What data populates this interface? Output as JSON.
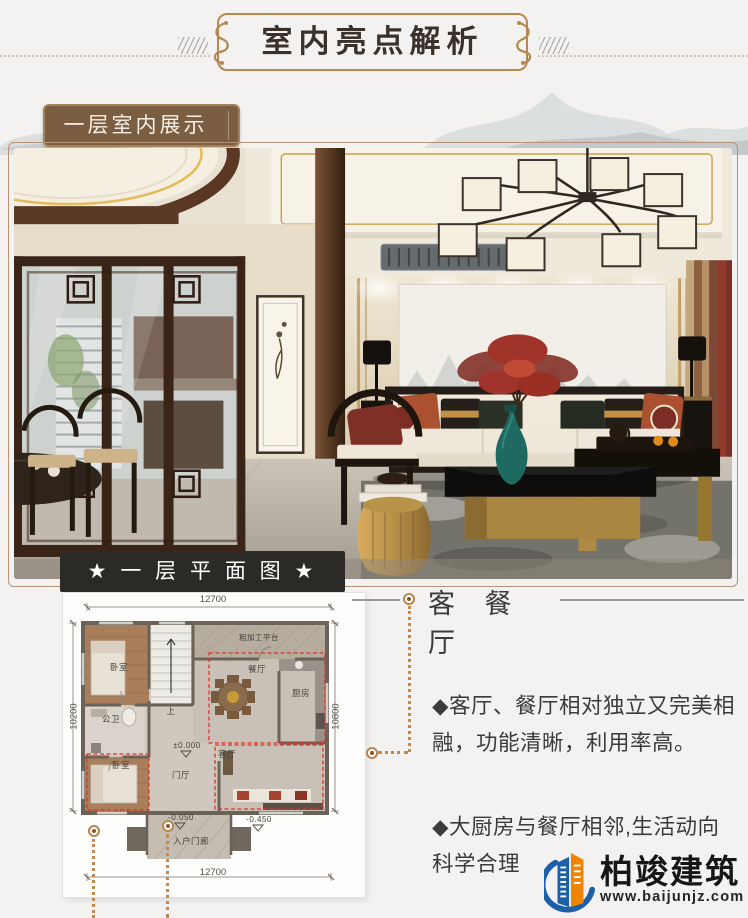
{
  "page": {
    "background": "#f3f2f0"
  },
  "header": {
    "title": "室内亮点解析",
    "frame_color": "#b4884f",
    "title_color": "#3a322a"
  },
  "section_label": {
    "text": "一层室内展示"
  },
  "plan_banner": {
    "text": "★ 一 层 平 面 图 ★"
  },
  "floor_plan": {
    "dims": {
      "top": "12700",
      "bottom": "12700",
      "left": "10200",
      "right": "10800"
    },
    "rooms": {
      "bedroom1": "卧室",
      "stairs": "上",
      "platform": "粗加工平台",
      "dining": "餐厅",
      "kitchen": "厨房",
      "bath": "公卫",
      "hall": "门厅",
      "bedroom2": "卧室",
      "living": "客厅",
      "porch": "入户门廊"
    },
    "levels": {
      "zero": "±0.000",
      "porch": "-0.050",
      "living": "-0.450"
    },
    "zone_color": "#e03228"
  },
  "callout": {
    "title": "客 餐 厅",
    "line_color": "#c08a50"
  },
  "notes": [
    "◆客厅、餐厅相对独立又完美相融，功能清晰，利用率高。",
    "◆大厨房与餐厅相邻,生活动向科学合理"
  ],
  "logo": {
    "name": "柏竣建筑",
    "website": "www.baijunjz.com",
    "blue": "#1d5fa8",
    "orange": "#f08300"
  }
}
